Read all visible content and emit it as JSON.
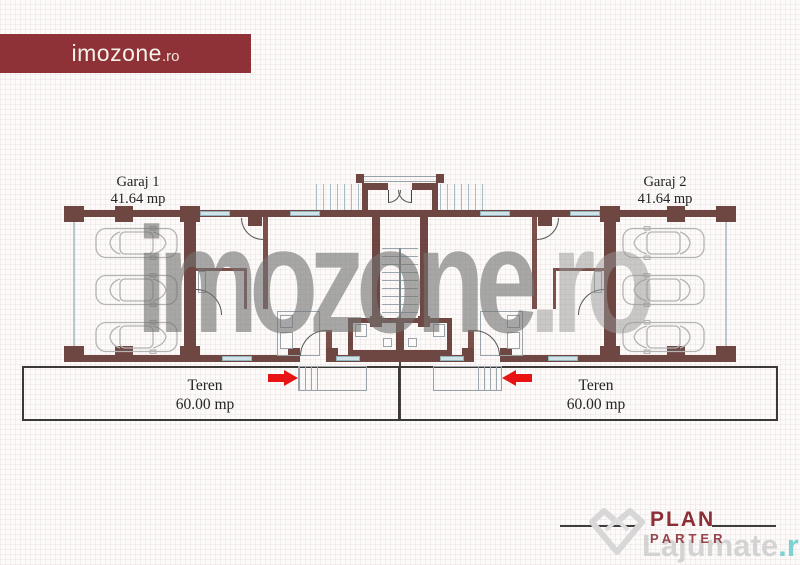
{
  "brand": {
    "name": "imozone",
    "tld": ".ro"
  },
  "plan": {
    "garage_left": {
      "name": "Garaj 1",
      "area": "41.64 mp"
    },
    "garage_right": {
      "name": "Garaj 2",
      "area": "41.64 mp"
    },
    "land_left": {
      "name": "Teren",
      "area": "60.00 mp"
    },
    "land_right": {
      "name": "Teren",
      "area": "60.00 mp"
    }
  },
  "footer": {
    "title": "PLAN",
    "subtitle": "PARTER"
  },
  "watermarks": {
    "center": {
      "main": "imozone",
      "tld": ".ro"
    },
    "corner": {
      "main": "Lajumate",
      "tld": ".ro"
    }
  },
  "colors": {
    "wall": "#6e4743",
    "brand_bg": "#8e3237",
    "arrow_red": "#e81414",
    "window_blue": "#cfe3e9",
    "plan_title_red": "#8b2e35",
    "watermark_gray": "#a4a4a4",
    "corner_tld_teal": "#7fd0d0"
  }
}
